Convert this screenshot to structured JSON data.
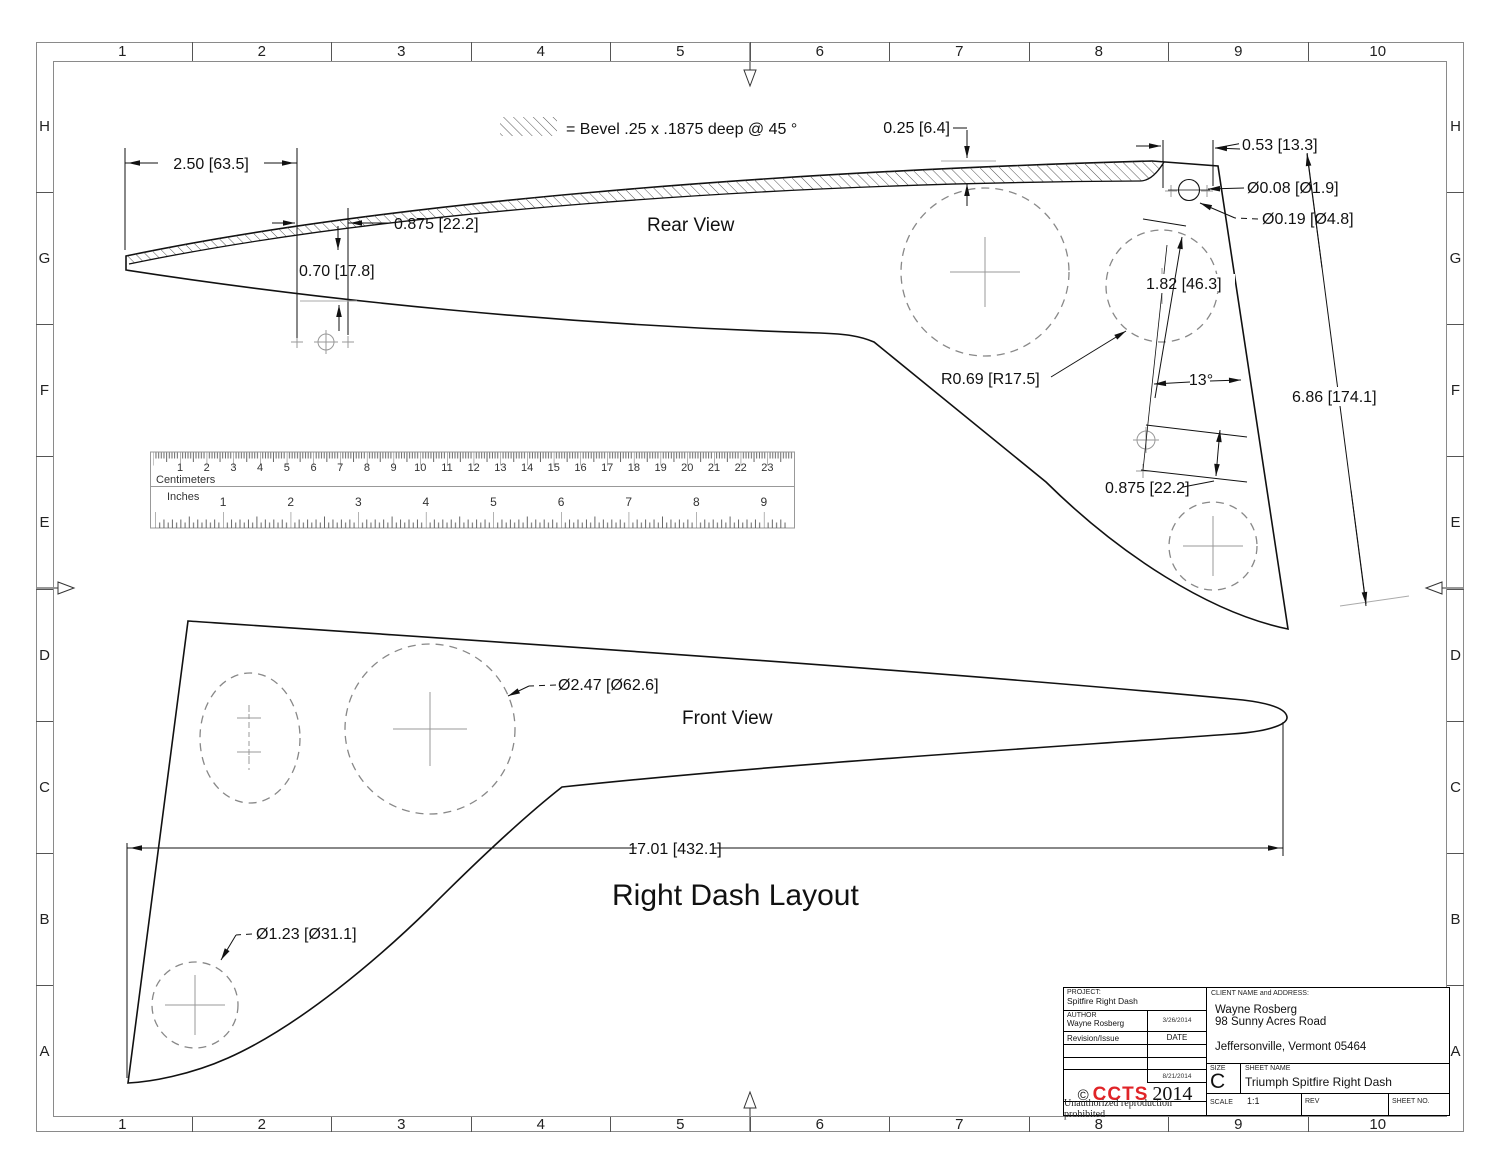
{
  "grid": {
    "cols": [
      "1",
      "2",
      "3",
      "4",
      "5",
      "6",
      "7",
      "8",
      "9",
      "10"
    ],
    "rows": [
      "H",
      "G",
      "F",
      "E",
      "D",
      "C",
      "B",
      "A"
    ]
  },
  "legend": {
    "bevel": "= Bevel .25 x .1875 deep @ 45 °"
  },
  "views": {
    "rear": "Rear View",
    "front": "Front View",
    "layout_title": "Right Dash Layout"
  },
  "dims": {
    "d250": "2.50 [63.5]",
    "d0875a": "0.875 [22.2]",
    "d070": "0.70 [17.8]",
    "d025": "0.25 [6.4]",
    "d053": "0.53 [13.3]",
    "d008": "Ø0.08 [Ø1.9]",
    "d019": "Ø0.19 [Ø4.8]",
    "d182": "1.82 [46.3]",
    "r069": "R0.69 [R17.5]",
    "a13": "13°",
    "d686": "6.86 [174.1]",
    "d0875b": "0.875 [22.2]",
    "d247": "Ø2.47 [Ø62.6]",
    "d1701": "17.01 [432.1]",
    "d123": "Ø1.23 [Ø31.1]"
  },
  "ruler": {
    "cm_label": "Centimeters",
    "inch_label": "Inches",
    "cm": [
      "1",
      "2",
      "3",
      "4",
      "5",
      "6",
      "7",
      "8",
      "9",
      "10",
      "11",
      "12",
      "13",
      "14",
      "15",
      "16",
      "17",
      "18",
      "19",
      "20",
      "21",
      "22",
      "23"
    ],
    "inch": [
      "1",
      "2",
      "3",
      "4",
      "5",
      "6",
      "7",
      "8",
      "9"
    ]
  },
  "title_block": {
    "project_label": "PROJECT:",
    "project": "Spitfire Right Dash",
    "author_label": "AUTHOR",
    "author": "Wayne Rosberg",
    "author_date": "3/26/2014",
    "revision_label": "Revision/Issue",
    "date_label": "DATE",
    "issue_date": "8/21/2014",
    "copyright": "©",
    "brand": "CCTS",
    "year": "2014",
    "notice": "Unauthorized reproduction prohibited",
    "client_label": "CLIENT NAME and ADDRESS:",
    "client_name": "Wayne Rosberg",
    "client_street": "98 Sunny Acres Road",
    "client_city": "Jeffersonville, Vermont 05464",
    "size_label": "SIZE",
    "size": "C",
    "sheet_name_label": "SHEET NAME",
    "sheet_name": "Triumph Spitfire Right Dash",
    "scale_label": "SCALE",
    "scale": "1:1",
    "rev_label": "REV",
    "sheet_no_label": "SHEET NO."
  },
  "colors": {
    "brand_red": "#e02428",
    "line": "#111111",
    "frame_gray": "#8a8a8a"
  }
}
